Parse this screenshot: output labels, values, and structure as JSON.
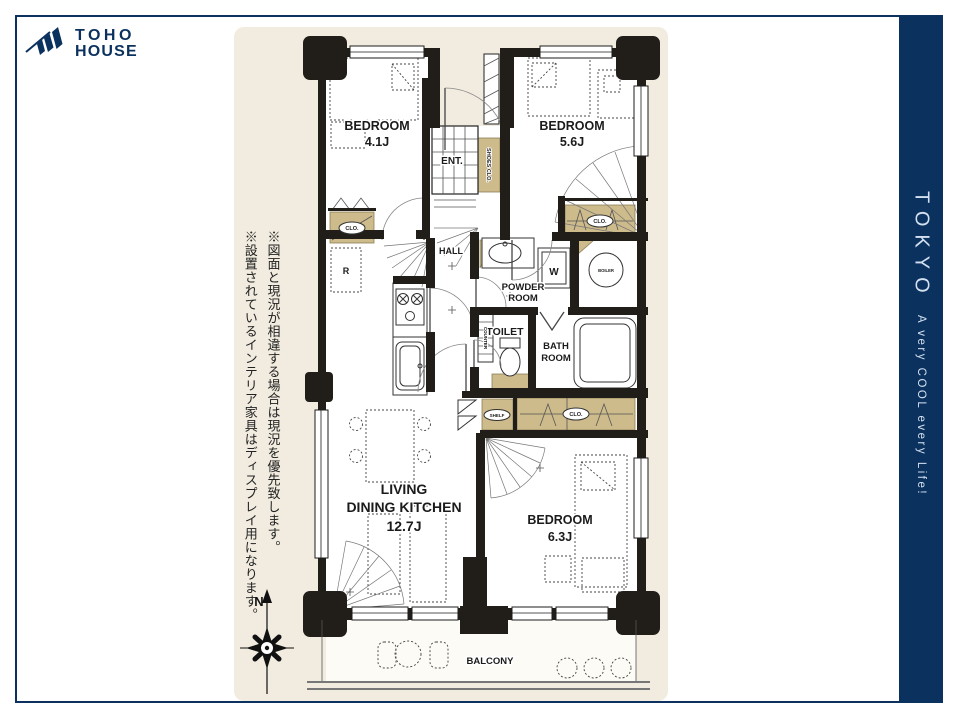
{
  "colors": {
    "navy": "#0b315f",
    "navy_text": "#d3e0ef",
    "cream": "#f1ecdf",
    "tan": "#cdbb8c",
    "wall": "#211d19",
    "line": "#333333"
  },
  "brand": {
    "line1": "TOHO",
    "line2": "HOUSE"
  },
  "banner": {
    "title": "TOKYO",
    "tagline": "A very COOL every Life!"
  },
  "disclaimer": {
    "col1": "※図面と現況が相違する場合は現況を優先致します。",
    "col2": "※設置されているインテリア家具はディスプレイ用になります。"
  },
  "compass": {
    "north": "N"
  },
  "floorplan": {
    "labels": {
      "bedroom1_name": "BEDROOM",
      "bedroom1_size": "4.1J",
      "bedroom2_name": "BEDROOM",
      "bedroom2_size": "5.6J",
      "bedroom3_name": "BEDROOM",
      "bedroom3_size": "6.3J",
      "ldk1": "LIVING",
      "ldk2": "DINING KITCHEN",
      "ldk3": "12.7J",
      "hall": "HALL",
      "ent": "ENT.",
      "shoes_clo": "SHOES CLO.",
      "powder1": "POWDER",
      "powder2": "ROOM",
      "toilet": "TOILET",
      "bath1": "BATH",
      "bath2": "ROOM",
      "boiler": "BOILER",
      "washer": "W",
      "counter": "COUNTER",
      "clo_b1": "CLO.",
      "clo_b2": "CLO.",
      "clo_b3": "CLO.",
      "shelf": "SHELF",
      "fridge": "R",
      "balcony": "BALCONY"
    }
  }
}
